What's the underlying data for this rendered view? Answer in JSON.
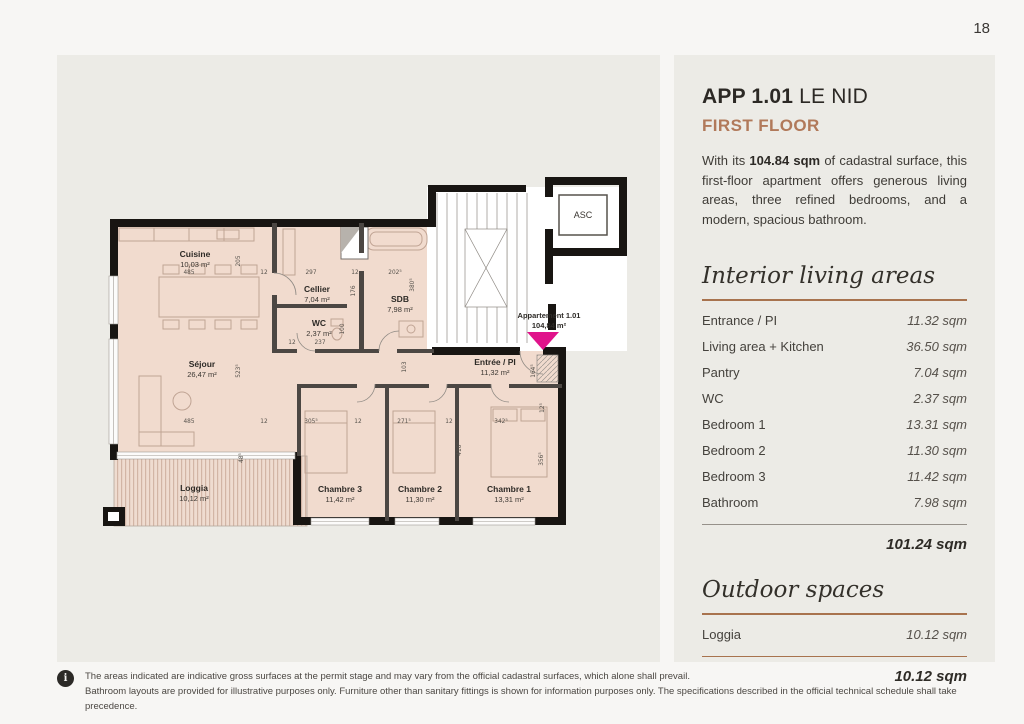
{
  "page": {
    "number": "18"
  },
  "apartment": {
    "title_bold": "APP 1.01",
    "title_rest": " LE NID",
    "subtitle": "FIRST FLOOR",
    "intro_prefix": "With its ",
    "intro_bold": "104.84 sqm",
    "intro_suffix": " of cadastral surface, this first-floor apartment offers generous living areas, three refined bedrooms, and a modern, spacious bathroom."
  },
  "interior": {
    "heading": "Interior living areas",
    "rows": [
      {
        "label": "Entrance / PI",
        "value": "11.32 sqm"
      },
      {
        "label": "Living area + Kitchen",
        "value": "36.50 sqm"
      },
      {
        "label": "Pantry",
        "value": "7.04 sqm"
      },
      {
        "label": "WC",
        "value": "2.37 sqm"
      },
      {
        "label": "Bedroom 1",
        "value": "13.31 sqm"
      },
      {
        "label": "Bedroom 2",
        "value": "11.30 sqm"
      },
      {
        "label": "Bedroom 3",
        "value": "11.42 sqm"
      },
      {
        "label": "Bathroom",
        "value": "7.98 sqm"
      }
    ],
    "total": "101.24 sqm"
  },
  "outdoor": {
    "heading": "Outdoor spaces",
    "rows": [
      {
        "label": "Loggia",
        "value": "10.12 sqm"
      }
    ],
    "total": "10.12 sqm"
  },
  "plan": {
    "elevator_label": "ASC",
    "marker": {
      "line1": "Appartement 1.01",
      "line2": "104,84 m²",
      "color": "#e0138b"
    },
    "rooms": [
      {
        "name": "Cuisine",
        "area": "10,03 m²",
        "x": 98,
        "y": 86
      },
      {
        "name": "Cellier",
        "area": "7,04 m²",
        "x": 220,
        "y": 121
      },
      {
        "name": "WC",
        "area": "2,37 m²",
        "x": 222,
        "y": 155
      },
      {
        "name": "SDB",
        "area": "7,98 m²",
        "x": 303,
        "y": 131
      },
      {
        "name": "Séjour",
        "area": "26,47 m²",
        "x": 105,
        "y": 196
      },
      {
        "name": "Entrée / PI",
        "area": "11,32 m²",
        "x": 398,
        "y": 194
      },
      {
        "name": "Chambre 3",
        "area": "11,42 m²",
        "x": 243,
        "y": 321
      },
      {
        "name": "Chambre 2",
        "area": "11,30 m²",
        "x": 323,
        "y": 321
      },
      {
        "name": "Chambre 1",
        "area": "13,31 m²",
        "x": 412,
        "y": 321
      },
      {
        "name": "Loggia",
        "area": "10,12 m²",
        "x": 97,
        "y": 320
      }
    ],
    "dims": [
      {
        "t": "485",
        "x": 92,
        "y": 103
      },
      {
        "t": "12",
        "x": 167,
        "y": 103
      },
      {
        "t": "297",
        "x": 214,
        "y": 103
      },
      {
        "t": "12",
        "x": 258,
        "y": 103
      },
      {
        "t": "202⁵",
        "x": 298,
        "y": 103
      },
      {
        "t": "485",
        "x": 92,
        "y": 252
      },
      {
        "t": "12",
        "x": 167,
        "y": 252
      },
      {
        "t": "305⁵",
        "x": 214,
        "y": 252
      },
      {
        "t": "12",
        "x": 261,
        "y": 252
      },
      {
        "t": "271⁵",
        "x": 307,
        "y": 252
      },
      {
        "t": "12",
        "x": 352,
        "y": 252
      },
      {
        "t": "342⁵",
        "x": 404,
        "y": 252
      },
      {
        "t": "237",
        "x": 223,
        "y": 173
      },
      {
        "t": "12",
        "x": 195,
        "y": 173
      },
      {
        "t": "205",
        "x": 143,
        "y": 90,
        "r": -90
      },
      {
        "t": "176",
        "x": 258,
        "y": 120,
        "r": -90
      },
      {
        "t": "380⁵",
        "x": 317,
        "y": 114,
        "r": -90
      },
      {
        "t": "100",
        "x": 247,
        "y": 158,
        "r": -90
      },
      {
        "t": "523⁵",
        "x": 143,
        "y": 200,
        "r": -90
      },
      {
        "t": "103",
        "x": 309,
        "y": 196,
        "r": -90
      },
      {
        "t": "48⁵",
        "x": 146,
        "y": 287,
        "r": -90
      },
      {
        "t": "164⁵",
        "x": 438,
        "y": 200,
        "r": -90
      },
      {
        "t": "12⁵",
        "x": 447,
        "y": 237,
        "r": -90
      },
      {
        "t": "416⁵",
        "x": 364,
        "y": 278,
        "r": -90
      },
      {
        "t": "356⁵",
        "x": 446,
        "y": 288,
        "r": -90
      }
    ]
  },
  "footer": {
    "icon": "i",
    "line1": "The areas indicated are indicative gross surfaces at the permit stage and may vary from the official cadastral surfaces, which alone shall prevail.",
    "line2": "Bathroom layouts are provided for illustrative purposes only. Furniture other than sanitary fittings is shown for information purposes only. The specifications described in the official technical schedule shall take precedence."
  },
  "colors": {
    "accent": "#b1795a",
    "rule": "#a8734e",
    "plan_fill": "#f1dbce",
    "wall": "#181512",
    "marker": "#e0138b"
  }
}
